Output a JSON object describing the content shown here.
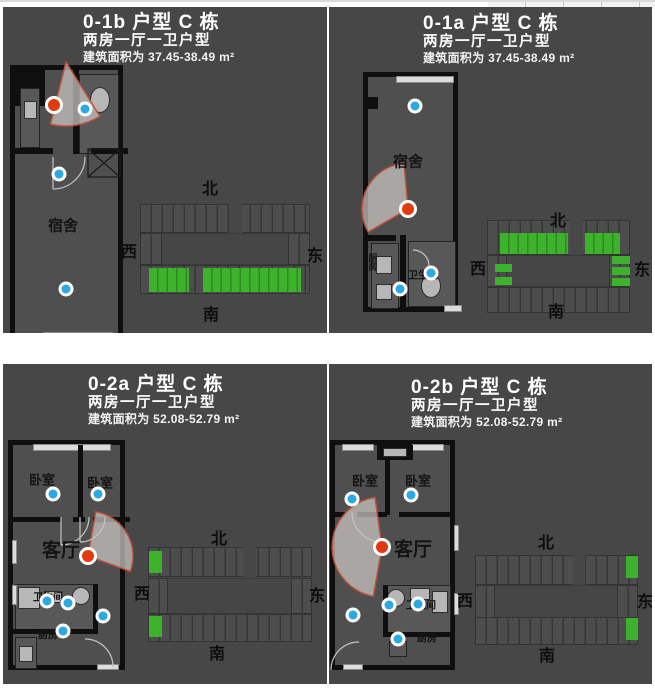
{
  "colors": {
    "panel_background": "#474747",
    "plan_floor": "#4f4f4f",
    "wall": "#0f0f0f",
    "camera_dot_red": "#e03a10",
    "sensor_dot_blue": "#2aa9e2",
    "highlight_green": "#3db22d",
    "title_text": "#ffffff",
    "label_text": "#141414"
  },
  "compass": {
    "north": "北",
    "west": "西",
    "east": "东",
    "south": "南"
  },
  "panels": [
    {
      "code": "0-1b",
      "title": "0-1b 户型 C 栋",
      "subtitle": "两房一厅一卫户型",
      "area": "建筑面积为 37.45-38.49 m²",
      "rooms": {
        "main": "宿舍"
      }
    },
    {
      "code": "0-1a",
      "title": "0-1a 户型 C 栋",
      "subtitle": "两房一厅一卫户型",
      "area": "建筑面积为 37.45-38.49 m²",
      "rooms": {
        "main": "宿舍",
        "bath": "卫生间",
        "kitchen": "厨房"
      }
    },
    {
      "code": "0-2a",
      "title": "0-2a 户型 C 栋",
      "subtitle": "两房一厅一卫户型",
      "area": "建筑面积为 52.08-52.79 m²",
      "rooms": {
        "bedroom_left": "卧室",
        "bedroom_right": "卧室",
        "living": "客厅",
        "bath": "卫生间",
        "kitchen": "厨房"
      }
    },
    {
      "code": "0-2b",
      "title": "0-2b 户型 C 栋",
      "subtitle": "两房一厅一卫户型",
      "area": "建筑面积为 52.08-52.79 m²",
      "rooms": {
        "bedroom_left": "卧室",
        "bedroom_right": "卧室",
        "living": "客厅",
        "bath": "卫生间",
        "kitchen": "厨房"
      }
    }
  ]
}
